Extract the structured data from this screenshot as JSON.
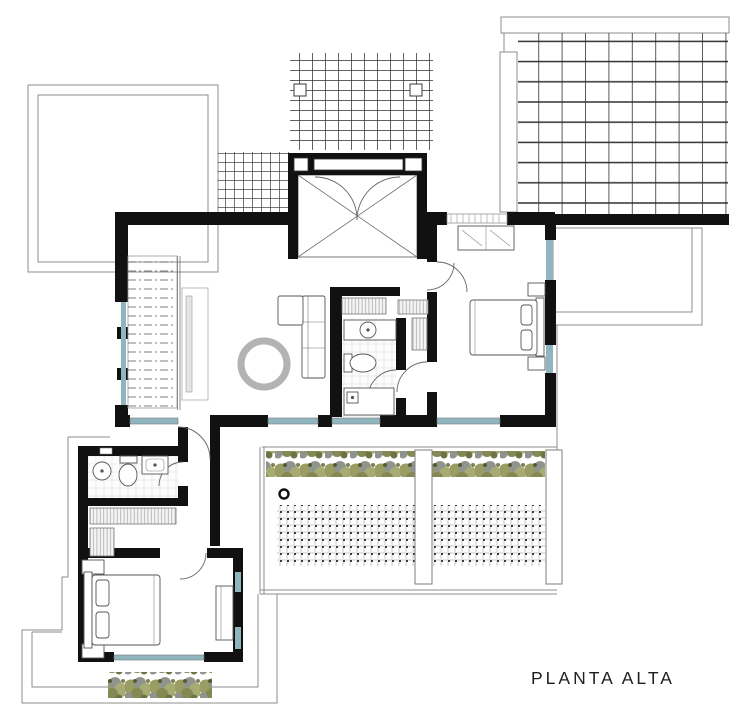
{
  "plan": {
    "title": "PLANTA ALTA"
  },
  "palette": {
    "background": "#ffffff",
    "wall": "#111111",
    "thin_outline": "#8c8c8c",
    "furniture_line": "#555555",
    "window_glass": "#8fb6bf",
    "hedge_olive": "#999d63",
    "hedge_olive_light": "#a7ab72",
    "hedge_olive_dark": "#848853",
    "hedge_gray": "#90948e",
    "rug_gray": "#b3b3b3",
    "deck_dot": "#3c3c3c",
    "title_text": "#1f1f1f"
  }
}
